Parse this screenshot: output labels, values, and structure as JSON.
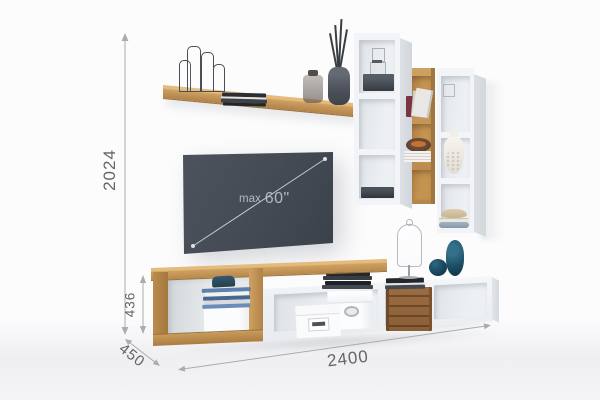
{
  "dimensions": {
    "total_height_mm": "2024",
    "bench_height_mm": "436",
    "depth_mm": "450",
    "total_width_mm": "2400"
  },
  "tv": {
    "label_prefix": "max",
    "label_size": "60\""
  },
  "colors": {
    "wood": "#c9995b",
    "white_furniture": "#f2f4f7",
    "tv_panel": "#454c56",
    "teal_accent": "#1d4f66",
    "dim_line": "#a9abad",
    "dim_text": "#636567"
  }
}
